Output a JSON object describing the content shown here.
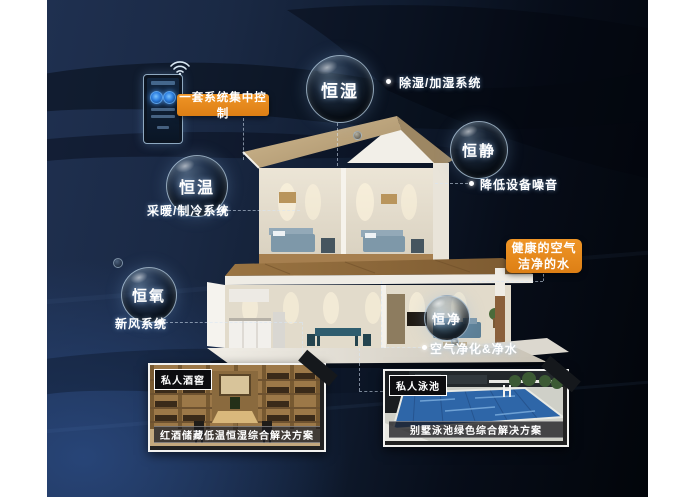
{
  "callouts": {
    "control": "一套系统集中控制",
    "healthy_line1": "健康的空气",
    "healthy_line2": "洁净的水"
  },
  "bubbles": [
    {
      "label": "恒湿",
      "note": "除湿/加湿系统"
    },
    {
      "label": "恒静",
      "note": "降低设备噪音"
    },
    {
      "label": "恒温",
      "note": "采暖/制冷系统"
    },
    {
      "label": "恒氧",
      "note": "新风系统"
    },
    {
      "label": "恒净",
      "note": "空气净化&净水"
    }
  ],
  "photos": [
    {
      "tag": "私人酒窖",
      "caption": "红酒储藏低温恒湿综合解决方案"
    },
    {
      "tag": "私人泳池",
      "caption": "别墅泳池绿色综合解决方案"
    }
  ],
  "icons": {
    "wifi": "wifi-icon"
  },
  "colors": {
    "accent_orange": "#E0861E",
    "background_navy": "#16243D",
    "bubble_rim": "#BED6EA",
    "text": "#FFFFFF"
  }
}
